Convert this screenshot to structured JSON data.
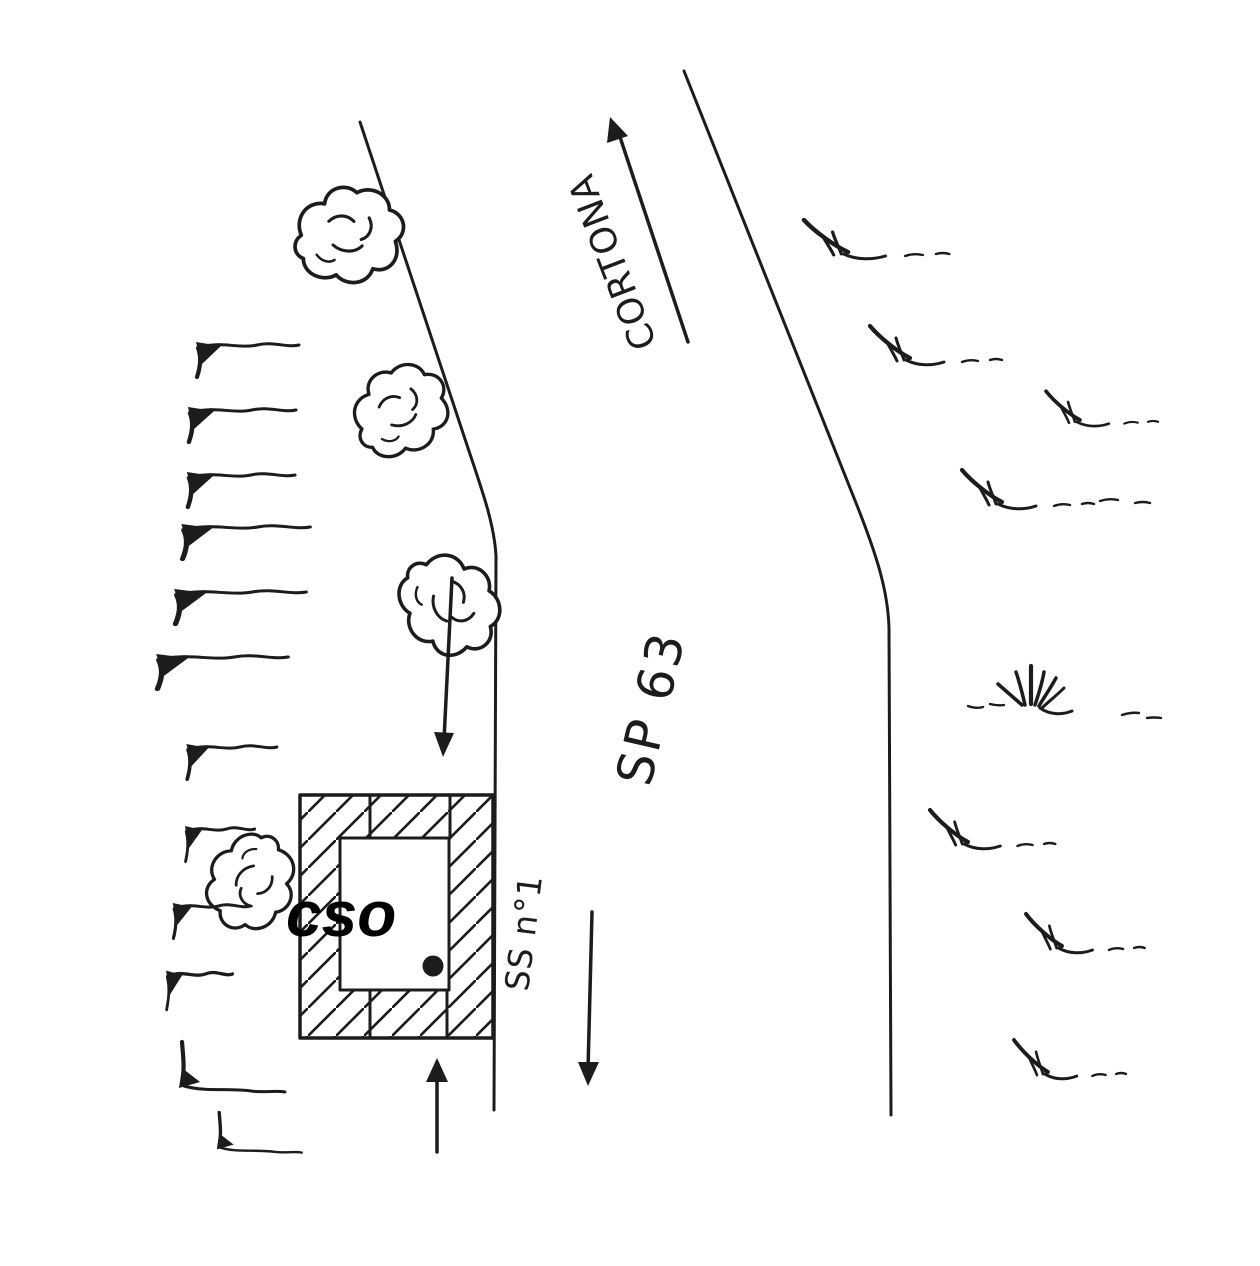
{
  "colors": {
    "ink": "#1c1c1c",
    "paper": "#ffffff"
  },
  "labels": {
    "direction_destination": "CORTONA",
    "provincial_road": "SP 63",
    "state_road": "SS n°1",
    "building": "cso"
  }
}
